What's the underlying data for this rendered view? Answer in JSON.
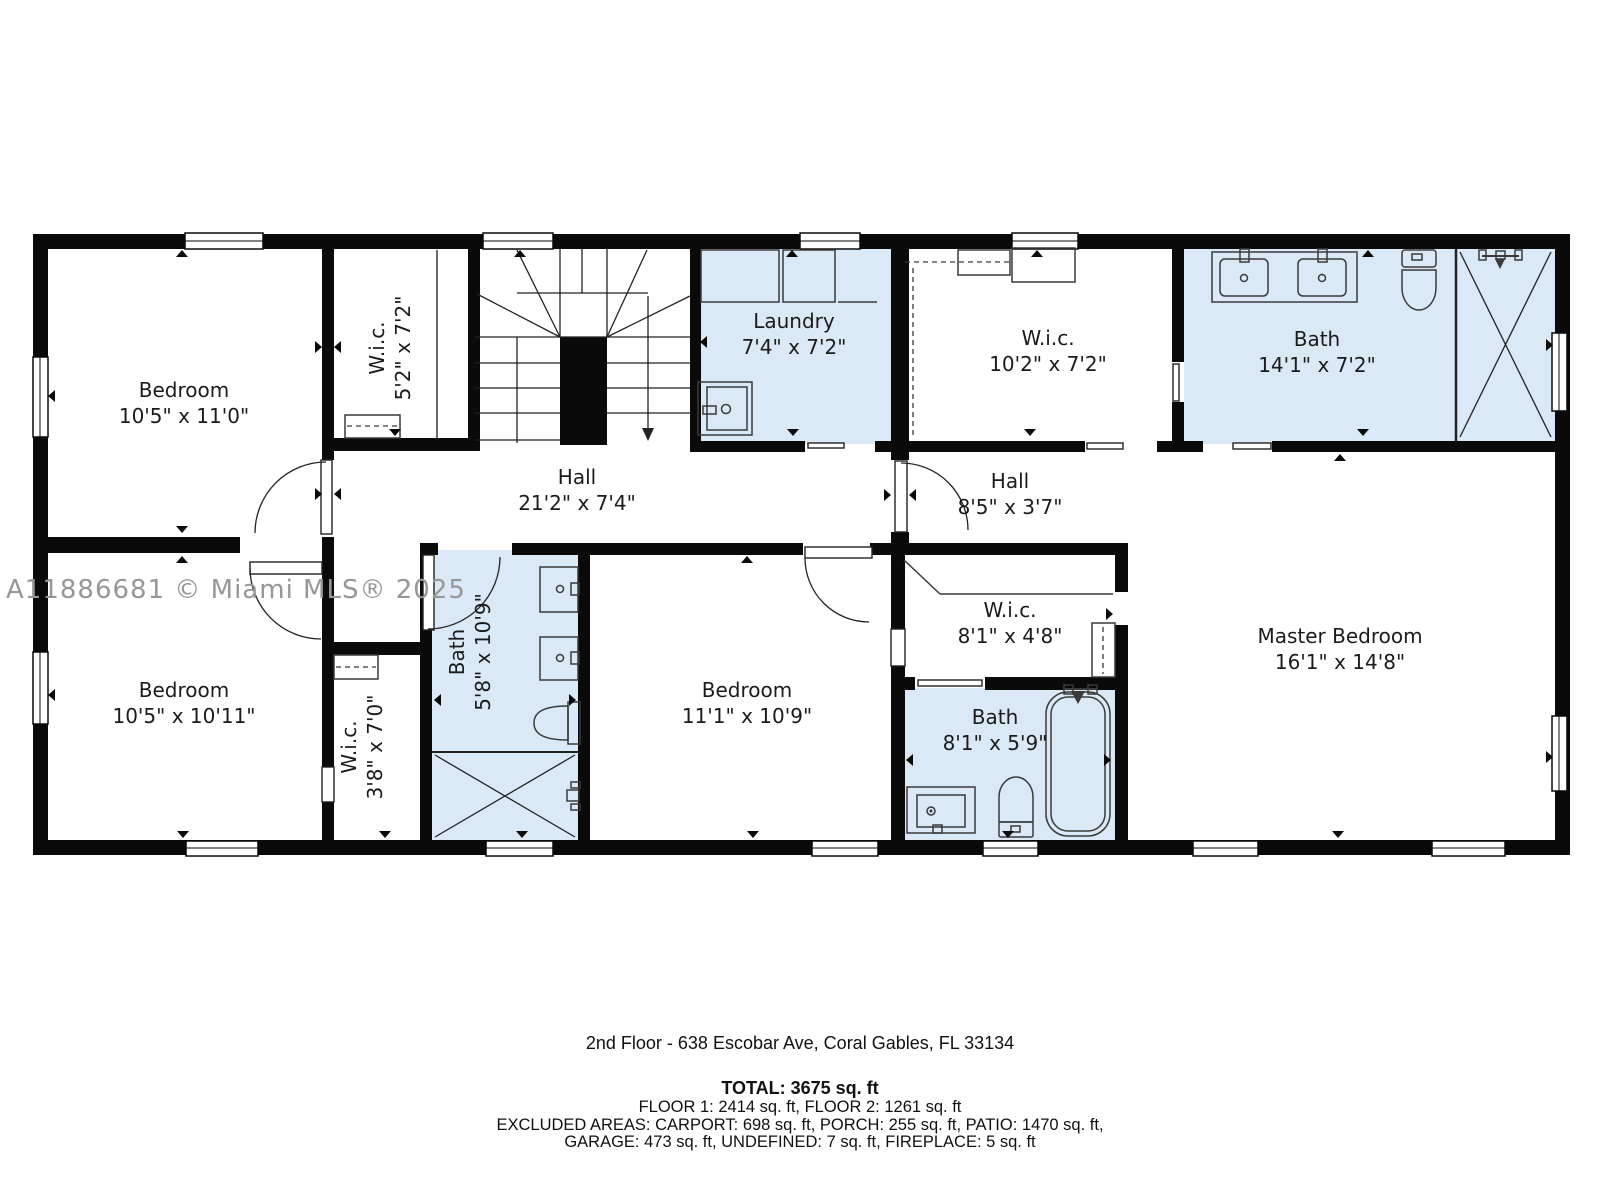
{
  "watermark": "A11886681 © Miami MLS® 2025",
  "colors": {
    "wall": "#0a0a0a",
    "wet_room": "#dbe9f6",
    "watermark_gray": "#979797"
  },
  "rooms": {
    "bedroom_top_left": {
      "name": "Bedroom",
      "dims": "10'5\" x 11'0\""
    },
    "wic_top_left": {
      "name": "W.i.c.",
      "dims": "5'2\" x 7'2\""
    },
    "laundry": {
      "name": "Laundry",
      "dims": "7'4\" x 7'2\""
    },
    "wic_top_center": {
      "name": "W.i.c.",
      "dims": "10'2\" x 7'2\""
    },
    "bath_top_right": {
      "name": "Bath",
      "dims": "14'1\" x 7'2\""
    },
    "hall_main": {
      "name": "Hall",
      "dims": "21'2\" x 7'4\""
    },
    "hall_master": {
      "name": "Hall",
      "dims": "8'5\" x 3'7\""
    },
    "bedroom_bottom_left": {
      "name": "Bedroom",
      "dims": "10'5\" x 10'11\""
    },
    "wic_bottom_left": {
      "name": "W.i.c.",
      "dims": "3'8\" x 7'0\""
    },
    "bath_middle": {
      "name": "Bath",
      "dims": "5'8\" x 10'9\""
    },
    "bedroom_middle": {
      "name": "Bedroom",
      "dims": "11'1\" x 10'9\""
    },
    "wic_master": {
      "name": "W.i.c.",
      "dims": "8'1\" x 4'8\""
    },
    "bath_master": {
      "name": "Bath",
      "dims": "8'1\" x 5'9\""
    },
    "master_bedroom": {
      "name": "Master Bedroom",
      "dims": "16'1\" x 14'8\""
    }
  },
  "footer": {
    "address": "2nd Floor - 638 Escobar Ave, Coral Gables, FL 33134",
    "total": "TOTAL: 3675 sq. ft",
    "floors": "FLOOR 1: 2414 sq. ft, FLOOR 2: 1261 sq. ft",
    "excluded_line1": "EXCLUDED AREAS: CARPORT: 698 sq. ft, PORCH: 255 sq. ft, PATIO: 1470 sq. ft,",
    "excluded_line2": "GARAGE: 473 sq. ft, UNDEFINED: 7 sq. ft, FIREPLACE: 5 sq. ft"
  }
}
